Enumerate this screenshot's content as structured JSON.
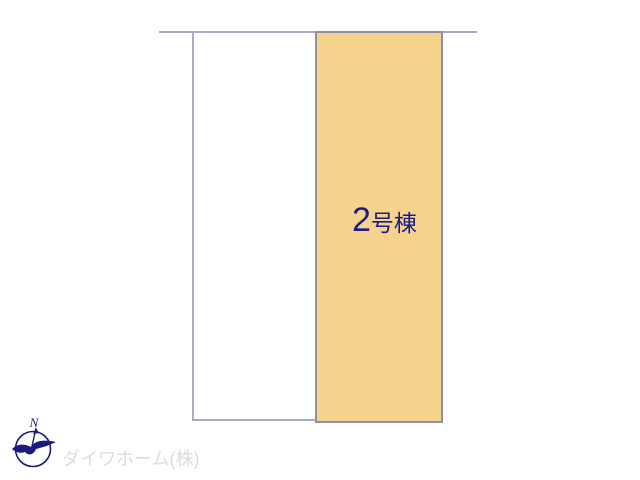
{
  "site_plan": {
    "plots": [
      {
        "id": "plot-empty",
        "label": ""
      },
      {
        "id": "plot-building-2",
        "label": "2号棟",
        "label_number": "2",
        "label_suffix": "号棟",
        "highlighted": true
      }
    ],
    "building_label": {
      "number": "2",
      "suffix": "号棟"
    },
    "company_name": "ダイワホーム(株)",
    "compass": {
      "north_label": "N"
    },
    "colors": {
      "highlight_fill": "#f6d38d",
      "highlight_border": "#90909f",
      "plot_border": "#a9a9cb",
      "boundary_line": "#a6a6c8",
      "label_text": "#1c1c86",
      "company_text": "#dcdcdc",
      "logo_navy": "#1b1b7e"
    }
  }
}
